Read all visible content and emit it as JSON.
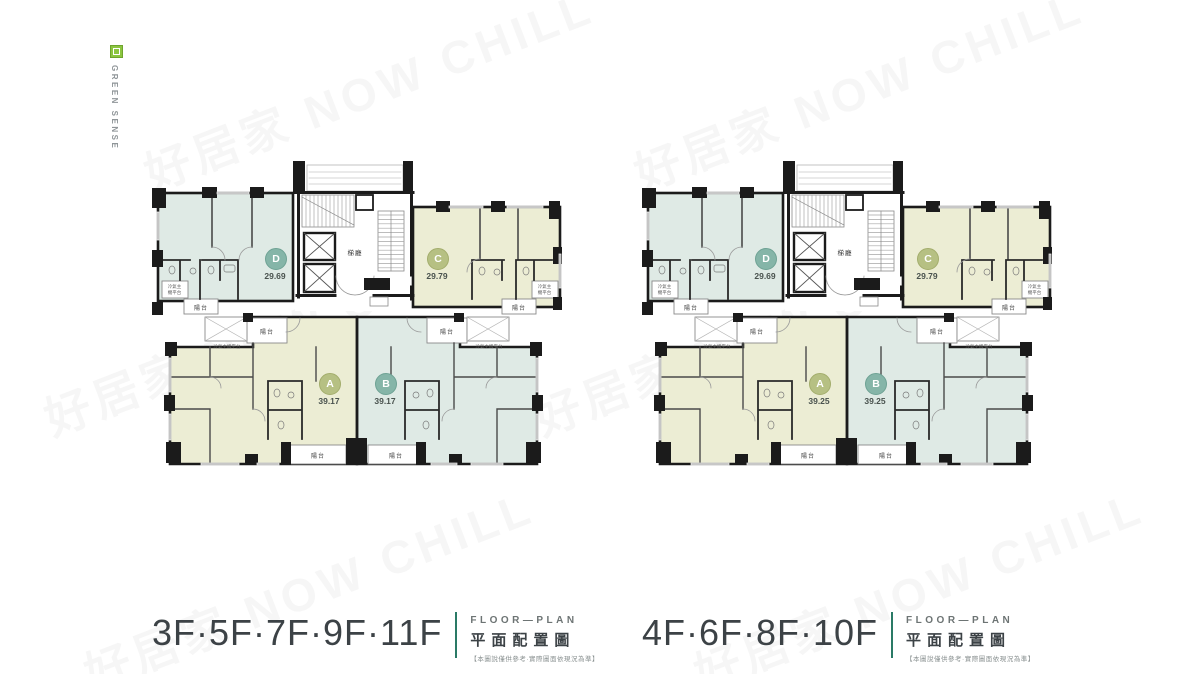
{
  "brand": {
    "name": "GREEN SENSE"
  },
  "watermark": {
    "text": "好居家 NOW CHILL"
  },
  "shared": {
    "lobby": "梯廳",
    "balcony": "陽台",
    "ac_platform": "冷氣主機平台",
    "subtitle_en": "FLOOR—PLAN",
    "subtitle_zh": "平面配置圖",
    "note": "【本圖說僅供參考·實際圖面依現況為準】"
  },
  "plans": [
    {
      "floors": "3F·5F·7F·9F·11F",
      "units": {
        "D": {
          "letter": "D",
          "area": "29.69"
        },
        "C": {
          "letter": "C",
          "area": "29.79"
        },
        "A": {
          "letter": "A",
          "area": "39.17"
        },
        "B": {
          "letter": "B",
          "area": "39.17"
        }
      }
    },
    {
      "floors": "4F·6F·8F·10F",
      "units": {
        "D": {
          "letter": "D",
          "area": "29.69"
        },
        "C": {
          "letter": "C",
          "area": "29.79"
        },
        "A": {
          "letter": "A",
          "area": "39.25"
        },
        "B": {
          "letter": "B",
          "area": "39.25"
        }
      }
    }
  ],
  "colors": {
    "unit_teal": "#dfeae5",
    "unit_olive": "#ecedd4",
    "badge_teal": "#85b5a8",
    "badge_olive": "#b6c083",
    "wall": "#1b1b1b",
    "accent_green": "#2a7a66",
    "logo_green": "#8bc53f"
  }
}
